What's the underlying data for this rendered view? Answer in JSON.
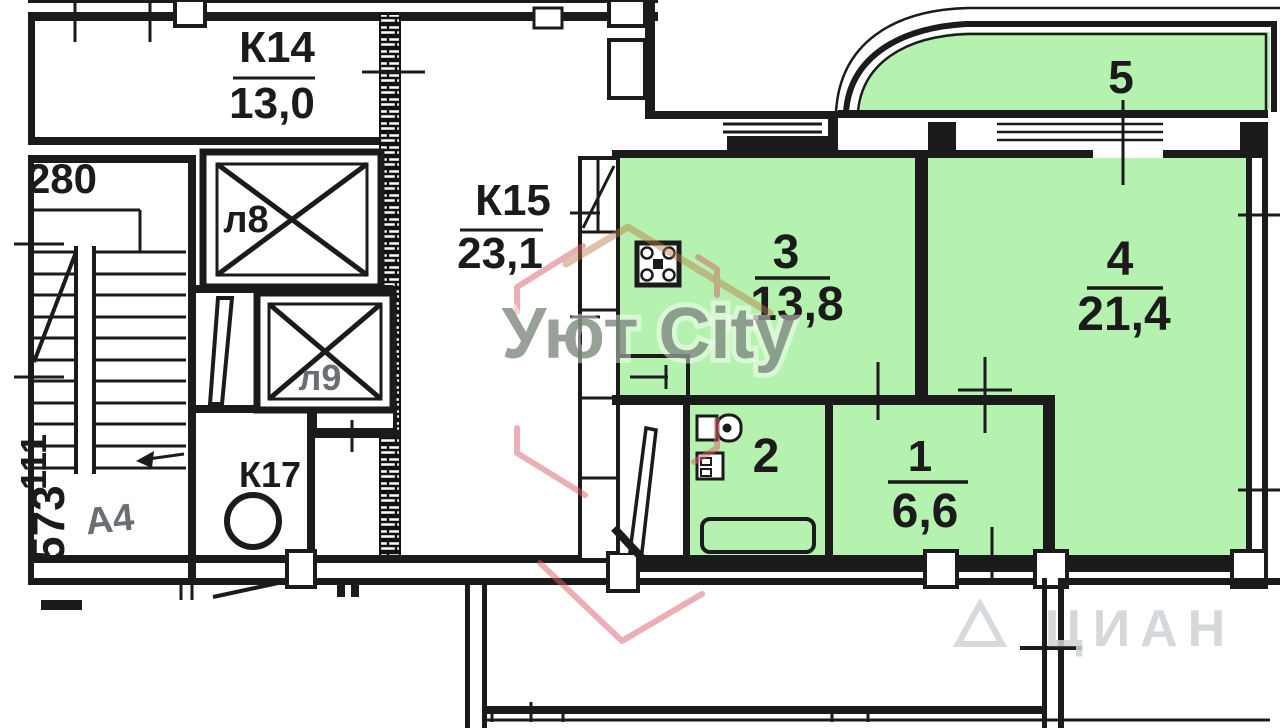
{
  "plan": {
    "k14": {
      "label": "К14",
      "area": "13,0"
    },
    "k15": {
      "label": "К15",
      "area": "23,1"
    },
    "k17": {
      "label": "К17"
    },
    "stair": {
      "number": "280",
      "note": "А4",
      "side_upper": "111",
      "side_lower": "573"
    },
    "elevators": {
      "left": "л8",
      "right": "л9"
    },
    "rooms": [
      {
        "number": "1",
        "area": "6,6"
      },
      {
        "number": "2",
        "area": ""
      },
      {
        "number": "3",
        "area": "13,8"
      },
      {
        "number": "4",
        "area": "21,4"
      },
      {
        "number": "5",
        "area": ""
      }
    ],
    "watermarks": {
      "center": "Уют City",
      "corner": "ЦИАН"
    },
    "colors": {
      "highlight": "#b6f2af",
      "wall": "#1b1b1b",
      "pink": "#d95f6b",
      "tan": "#b97a48",
      "gray": "#6f7d70"
    }
  }
}
